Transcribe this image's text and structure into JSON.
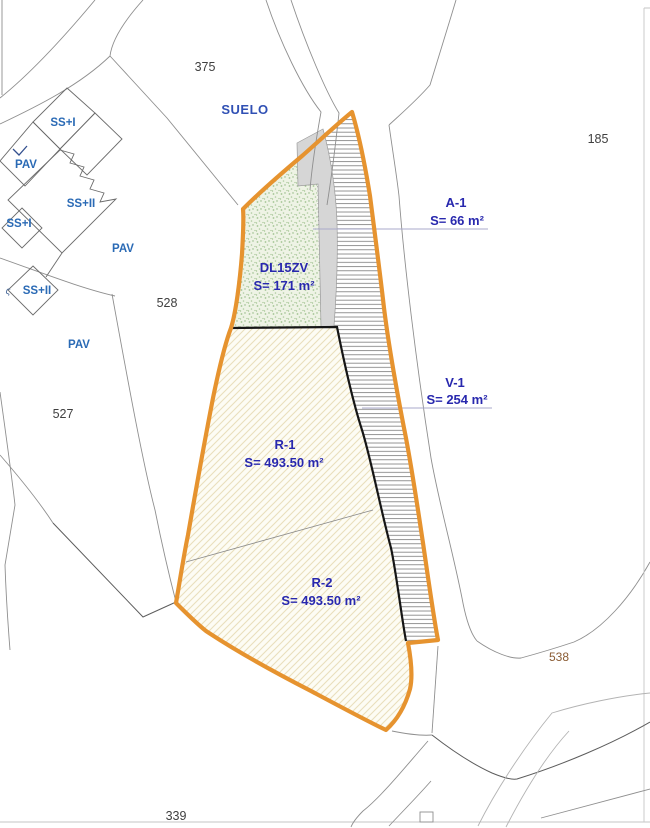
{
  "colors": {
    "orange_boundary": "#E6932F",
    "zone_label_blue": "#2828AE",
    "building_label_blue": "#2A6AB5",
    "suelo_label_blue": "#3050B4",
    "parcel_number_gray": "#404040",
    "ref_538_brown": "#8A5B33",
    "leader_line": "#A9A9CB",
    "gray_fill": "#D6D6D6",
    "green_fill": "#EEF3E5",
    "r_hatch_background": "#FDFCF4"
  },
  "zones": {
    "a1": {
      "name": "A-1",
      "area": "S= 66 m²"
    },
    "v1": {
      "name": "V-1",
      "area": "S= 254 m²"
    },
    "dl15zv": {
      "name": "DL15ZV",
      "area": "S= 171 m²"
    },
    "r1": {
      "name": "R-1",
      "area": "S= 493.50 m²"
    },
    "r2": {
      "name": "R-2",
      "area": "S= 493.50 m²"
    }
  },
  "land_labels": {
    "suelo": "SUELO"
  },
  "parcel_numbers": {
    "n375": "375",
    "n185": "185",
    "n528": "528",
    "n527": "527",
    "n339": "339",
    "n538": "538"
  },
  "building_labels": {
    "ss_i_top": "SS+I",
    "pav_top": "PAV",
    "ss_ii_mid": "SS+II",
    "ss_i_left": "SS+I",
    "pav_mid": "PAV",
    "ss_ii_bottom": "SS+II",
    "pav_bottom": "PAV",
    "stair_symbol": "ς"
  }
}
